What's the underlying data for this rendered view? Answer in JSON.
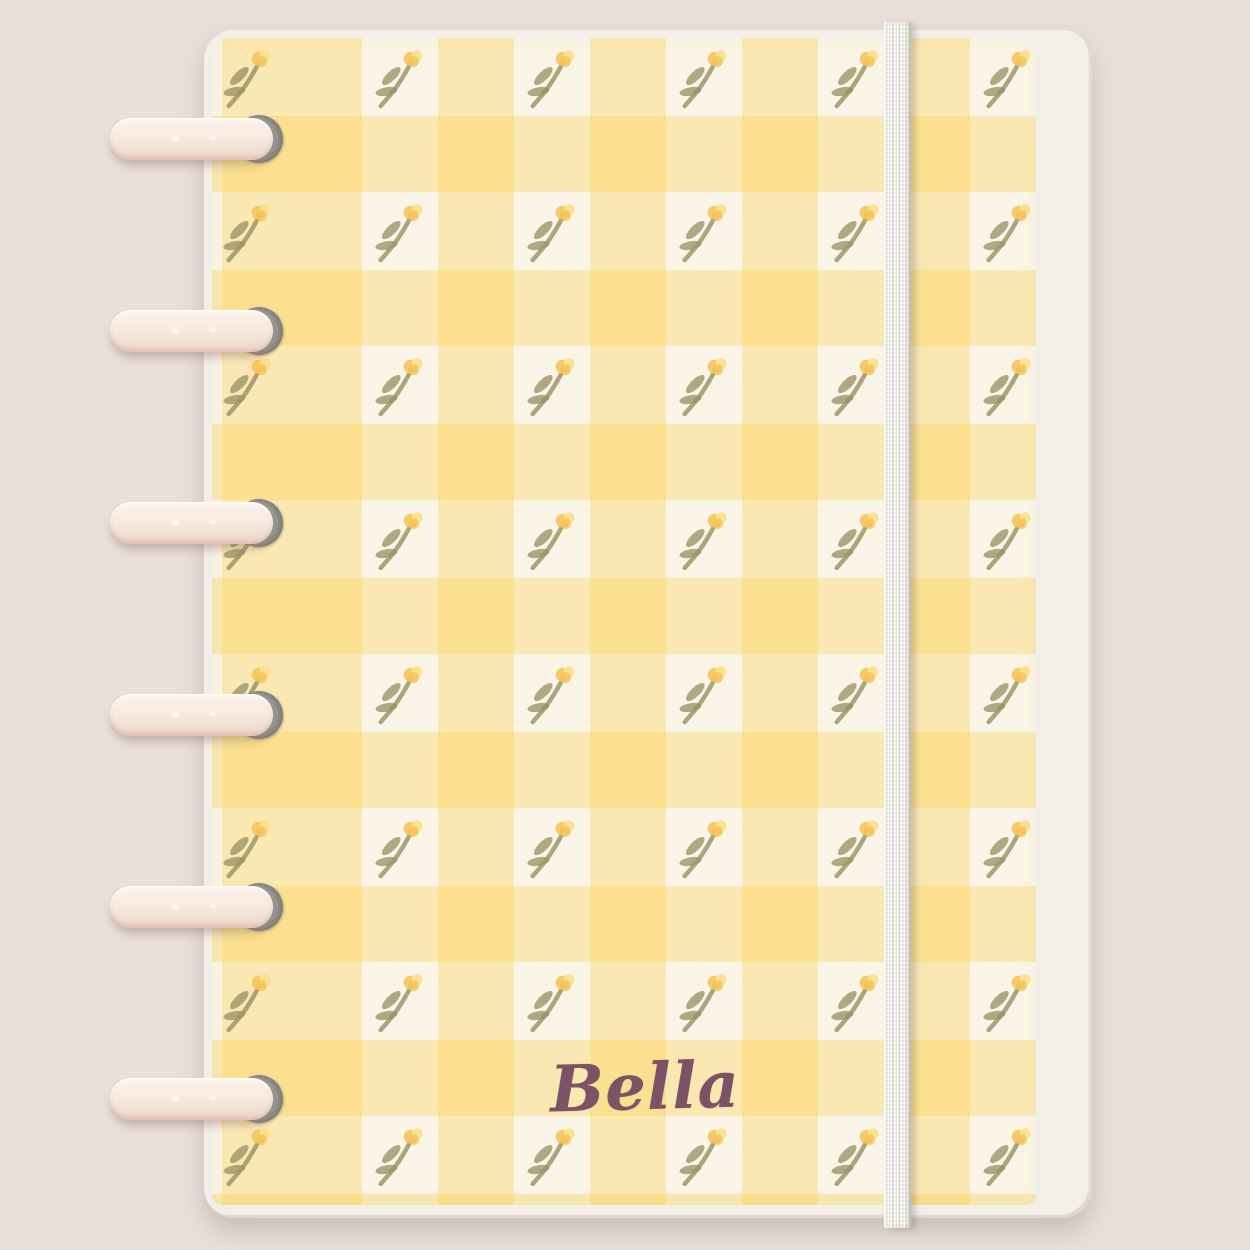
{
  "scene": {
    "background_color": "#e8dfd8"
  },
  "notebook": {
    "backing_sheet": {
      "color": "#f3eee7"
    },
    "cover": {
      "pattern_name": "yellow-gingham-with-tulip-sprigs",
      "base_color": "#faf5e7",
      "check_overlay": "rgba(249, 206, 73, 0.33)",
      "light_check_color": "#fbe9ae",
      "dark_check_color": "#f8df96",
      "grid": {
        "flower_columns": 6,
        "flower_rows": 8
      },
      "flower": {
        "petal_color": "#f3c55c",
        "petal_highlight_color": "#fbdf8e",
        "stem_color": "#9b9266"
      }
    },
    "monogram": {
      "text": "Bella",
      "color": "#7b5365"
    },
    "discs": {
      "count": 6,
      "light_color": "#fbf2ea",
      "dark_color": "#e9d4c6",
      "hole_color": "#8d8b86"
    },
    "elastic_band": {
      "color": "#ecebe2",
      "edge_color": "#c6c4b8"
    }
  }
}
